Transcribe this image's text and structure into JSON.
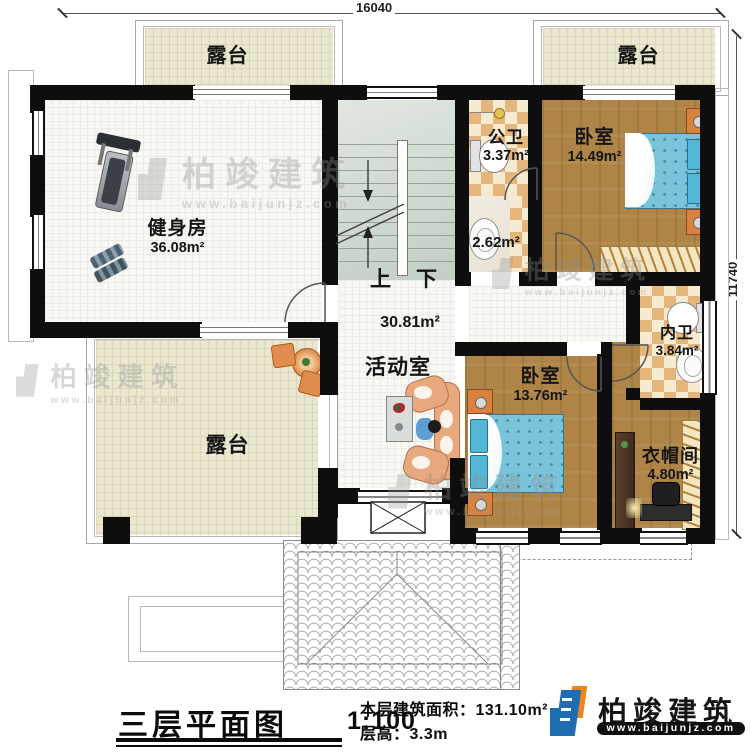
{
  "dimensions": {
    "top": "16040",
    "right": "11740"
  },
  "stairs": {
    "up": "上",
    "down": "下"
  },
  "rooms": {
    "terrace_top_left": {
      "label": "露台"
    },
    "terrace_top_right": {
      "label": "露台"
    },
    "terrace_bottom": {
      "label": "露台"
    },
    "gym": {
      "label": "健身房",
      "area": "36.08m²"
    },
    "public_bath": {
      "label": "公卫",
      "area": "3.37m²"
    },
    "wash_area": {
      "area": "2.62m²"
    },
    "bedroom_top": {
      "label": "卧室",
      "area": "14.49m²"
    },
    "inner_bath": {
      "label": "内卫",
      "area": "3.84m²"
    },
    "activity": {
      "label": "活动室",
      "area": "30.81m²"
    },
    "bedroom_mid": {
      "label": "卧室",
      "area": "13.76m²"
    },
    "cloakroom": {
      "label": "衣帽间",
      "area": "4.80m²"
    }
  },
  "title_block": {
    "plan_title": "三层平面图",
    "scale": "1:100",
    "floor_area": "本层建筑面积：131.10m²",
    "floor_height": "层高：3.3m"
  },
  "brand": {
    "name": "柏竣建筑",
    "site": "www.baijunjz.com"
  },
  "watermark": {
    "name": "柏竣建筑",
    "site": "www.baijunjz.com"
  },
  "colors": {
    "wall": "#0e0e0e",
    "wood_floor": "#ae8547",
    "terrace_floor": "#ebe8d2",
    "tile_dark": "#e5b67c",
    "tile_light": "#f6ebd0",
    "stair_floor": "#d4dfd6",
    "bed_blue": "#7ac4da",
    "furniture_orange": "#d9813f",
    "brand_blue": "#1e6db3",
    "brand_orange": "#f08519"
  }
}
